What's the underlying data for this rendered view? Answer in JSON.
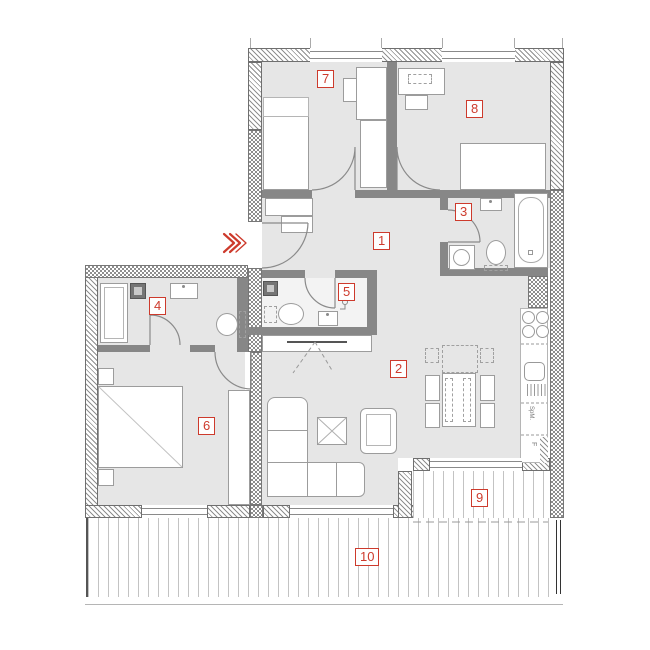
{
  "colors": {
    "accent": "#cd3a2c",
    "wall": "#878787",
    "floor": "#e6e6e6"
  },
  "room_labels": [
    "1",
    "2",
    "3",
    "4",
    "5",
    "6",
    "7",
    "8",
    "9",
    "10"
  ],
  "kitchen": {
    "dishwasher_label": "SpM.",
    "fridge_label": "F"
  }
}
